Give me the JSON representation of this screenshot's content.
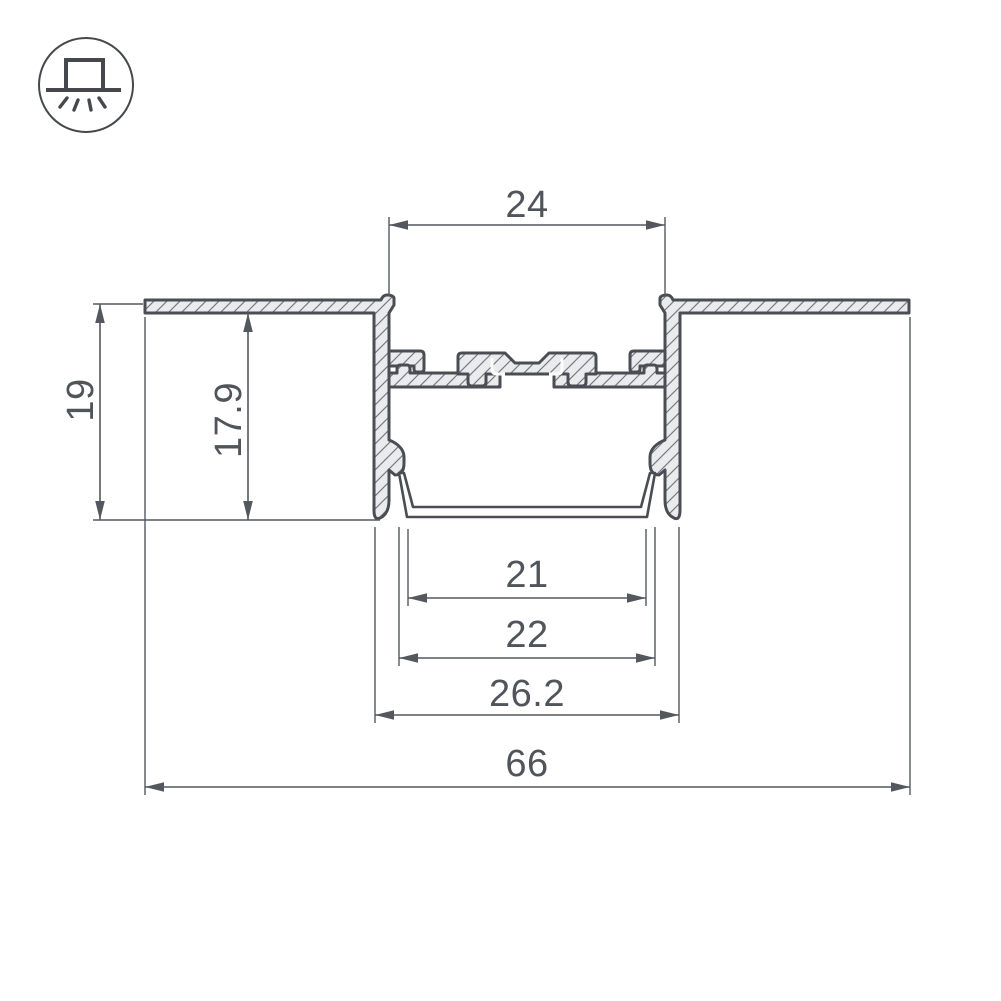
{
  "page": {
    "background": "#ffffff"
  },
  "badge": {
    "icon": "recessed-mount-luminaire-icon"
  },
  "drawing": {
    "type": "led-profile-cross-section",
    "dimensions": {
      "top_opening_width": "24",
      "recess_height": "19",
      "inner_height": "17.9",
      "bottom_inner_width": "21",
      "diffuser_width": "22",
      "body_width": "26.2",
      "overall_width": "66"
    },
    "colors": {
      "outline": "#4a4e54",
      "dimension": "#54585e",
      "metal_fill": "#e9ebec",
      "hatch_line": "#787d82",
      "background": "#ffffff"
    }
  }
}
